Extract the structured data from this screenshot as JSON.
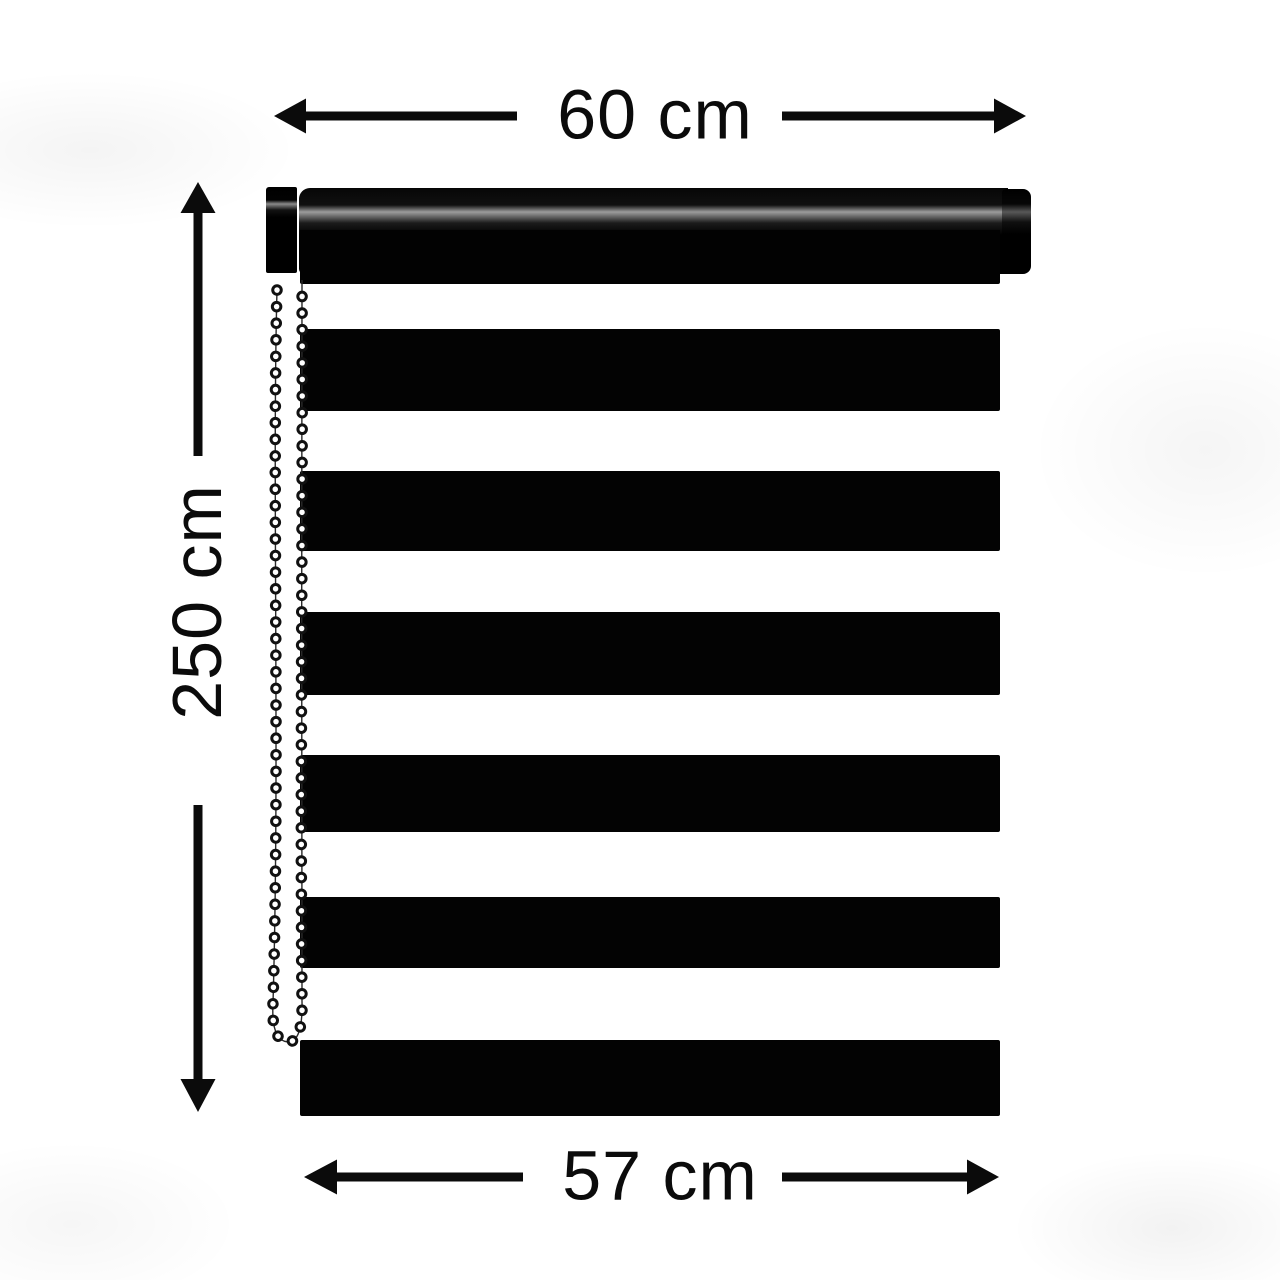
{
  "diagram": {
    "type": "product-dimension-diagram",
    "subject": "black and white striped zebra roller blind with headrail, side brackets and bead control chain",
    "dimensions": {
      "width_top": "60 cm",
      "height_left": "250 cm",
      "width_bottom": "57 cm"
    },
    "colors": {
      "ink": "#0b0b0b",
      "stripe": "#030303",
      "background": "#ffffff",
      "chain_bead_fill": "#ffffff",
      "chain_bead_outline": "#111111"
    },
    "blind": {
      "stripe_count": 7,
      "headrail_parts": [
        "left-bracket",
        "roller-tube",
        "right-end-cap"
      ],
      "chain_side": "left"
    }
  }
}
